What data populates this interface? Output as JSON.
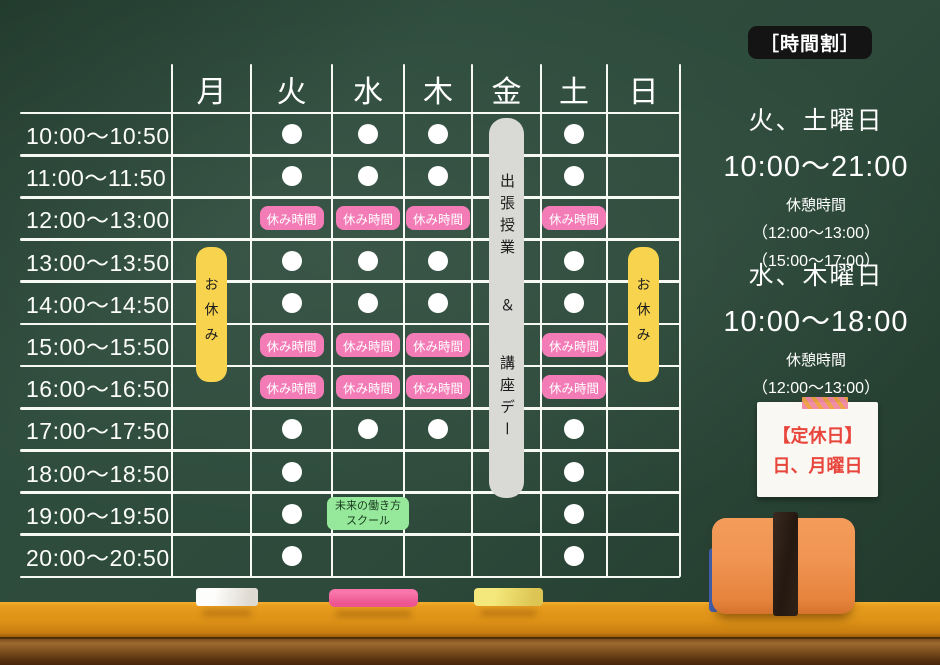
{
  "board": {
    "title_badge": "［時間割］"
  },
  "timetable": {
    "days": [
      "月",
      "火",
      "水",
      "木",
      "金",
      "土",
      "日"
    ],
    "times": [
      "10:00〜10:50",
      "11:00〜11:50",
      "12:00〜13:00",
      "13:00〜13:50",
      "14:00〜14:50",
      "15:00〜15:50",
      "16:00〜16:50",
      "17:00〜17:50",
      "18:00〜18:50",
      "19:00〜19:50",
      "20:00〜20:50"
    ],
    "schedule": [
      [
        "",
        "L",
        "L",
        "L",
        "",
        "L",
        ""
      ],
      [
        "",
        "L",
        "L",
        "L",
        "",
        "L",
        ""
      ],
      [
        "",
        "B",
        "B",
        "B",
        "",
        "B",
        ""
      ],
      [
        "",
        "L",
        "L",
        "L",
        "",
        "L",
        ""
      ],
      [
        "",
        "L",
        "L",
        "L",
        "",
        "L",
        ""
      ],
      [
        "",
        "B",
        "B",
        "B",
        "",
        "B",
        ""
      ],
      [
        "",
        "B",
        "B",
        "B",
        "",
        "B",
        ""
      ],
      [
        "",
        "L",
        "L",
        "L",
        "",
        "L",
        ""
      ],
      [
        "",
        "L",
        "",
        "",
        "",
        "L",
        ""
      ],
      [
        "",
        "L",
        "S",
        "",
        "",
        "L",
        ""
      ],
      [
        "",
        "L",
        "",
        "",
        "",
        "L",
        ""
      ]
    ],
    "labels": {
      "lesson_marker": "●",
      "break": "休み時間",
      "closed": "お休み",
      "friday_event_parts": [
        "出張授業",
        "＆",
        "講座デー"
      ],
      "school_lines": [
        "未来の働き方",
        "スクール"
      ]
    },
    "closed_columns": [
      "月",
      "日"
    ]
  },
  "sidebar": {
    "blocks": [
      {
        "days": "火、土曜日",
        "hours": "10:00〜21:00",
        "break_title": "休憩時間",
        "breaks": [
          "（12:00〜13:00）",
          "（15:00〜17:00）"
        ]
      },
      {
        "days": "水、木曜日",
        "hours": "10:00〜18:00",
        "break_title": "休憩時間",
        "breaks": [
          "（12:00〜13:00）",
          "（15:00〜17:00）"
        ]
      }
    ],
    "note": {
      "title": "【定休日】",
      "days": "日、月曜日"
    }
  },
  "colors": {
    "board_green": "#2d4a3b",
    "grid_white": "#f7faf4",
    "lesson_dot": "#ffffff",
    "break_badge": "#f47cb6",
    "closed_badge": "#f8d44e",
    "friday_badge": "#d9d9d6",
    "school_badge": "#96e89b",
    "title_badge_bg": "#141414",
    "note_red": "#e8453c",
    "tray_orange": "#dd9116",
    "eraser_orange": "#ef9452",
    "chalk_pink": "#f0609a",
    "chalk_yellow": "#eee06a"
  }
}
